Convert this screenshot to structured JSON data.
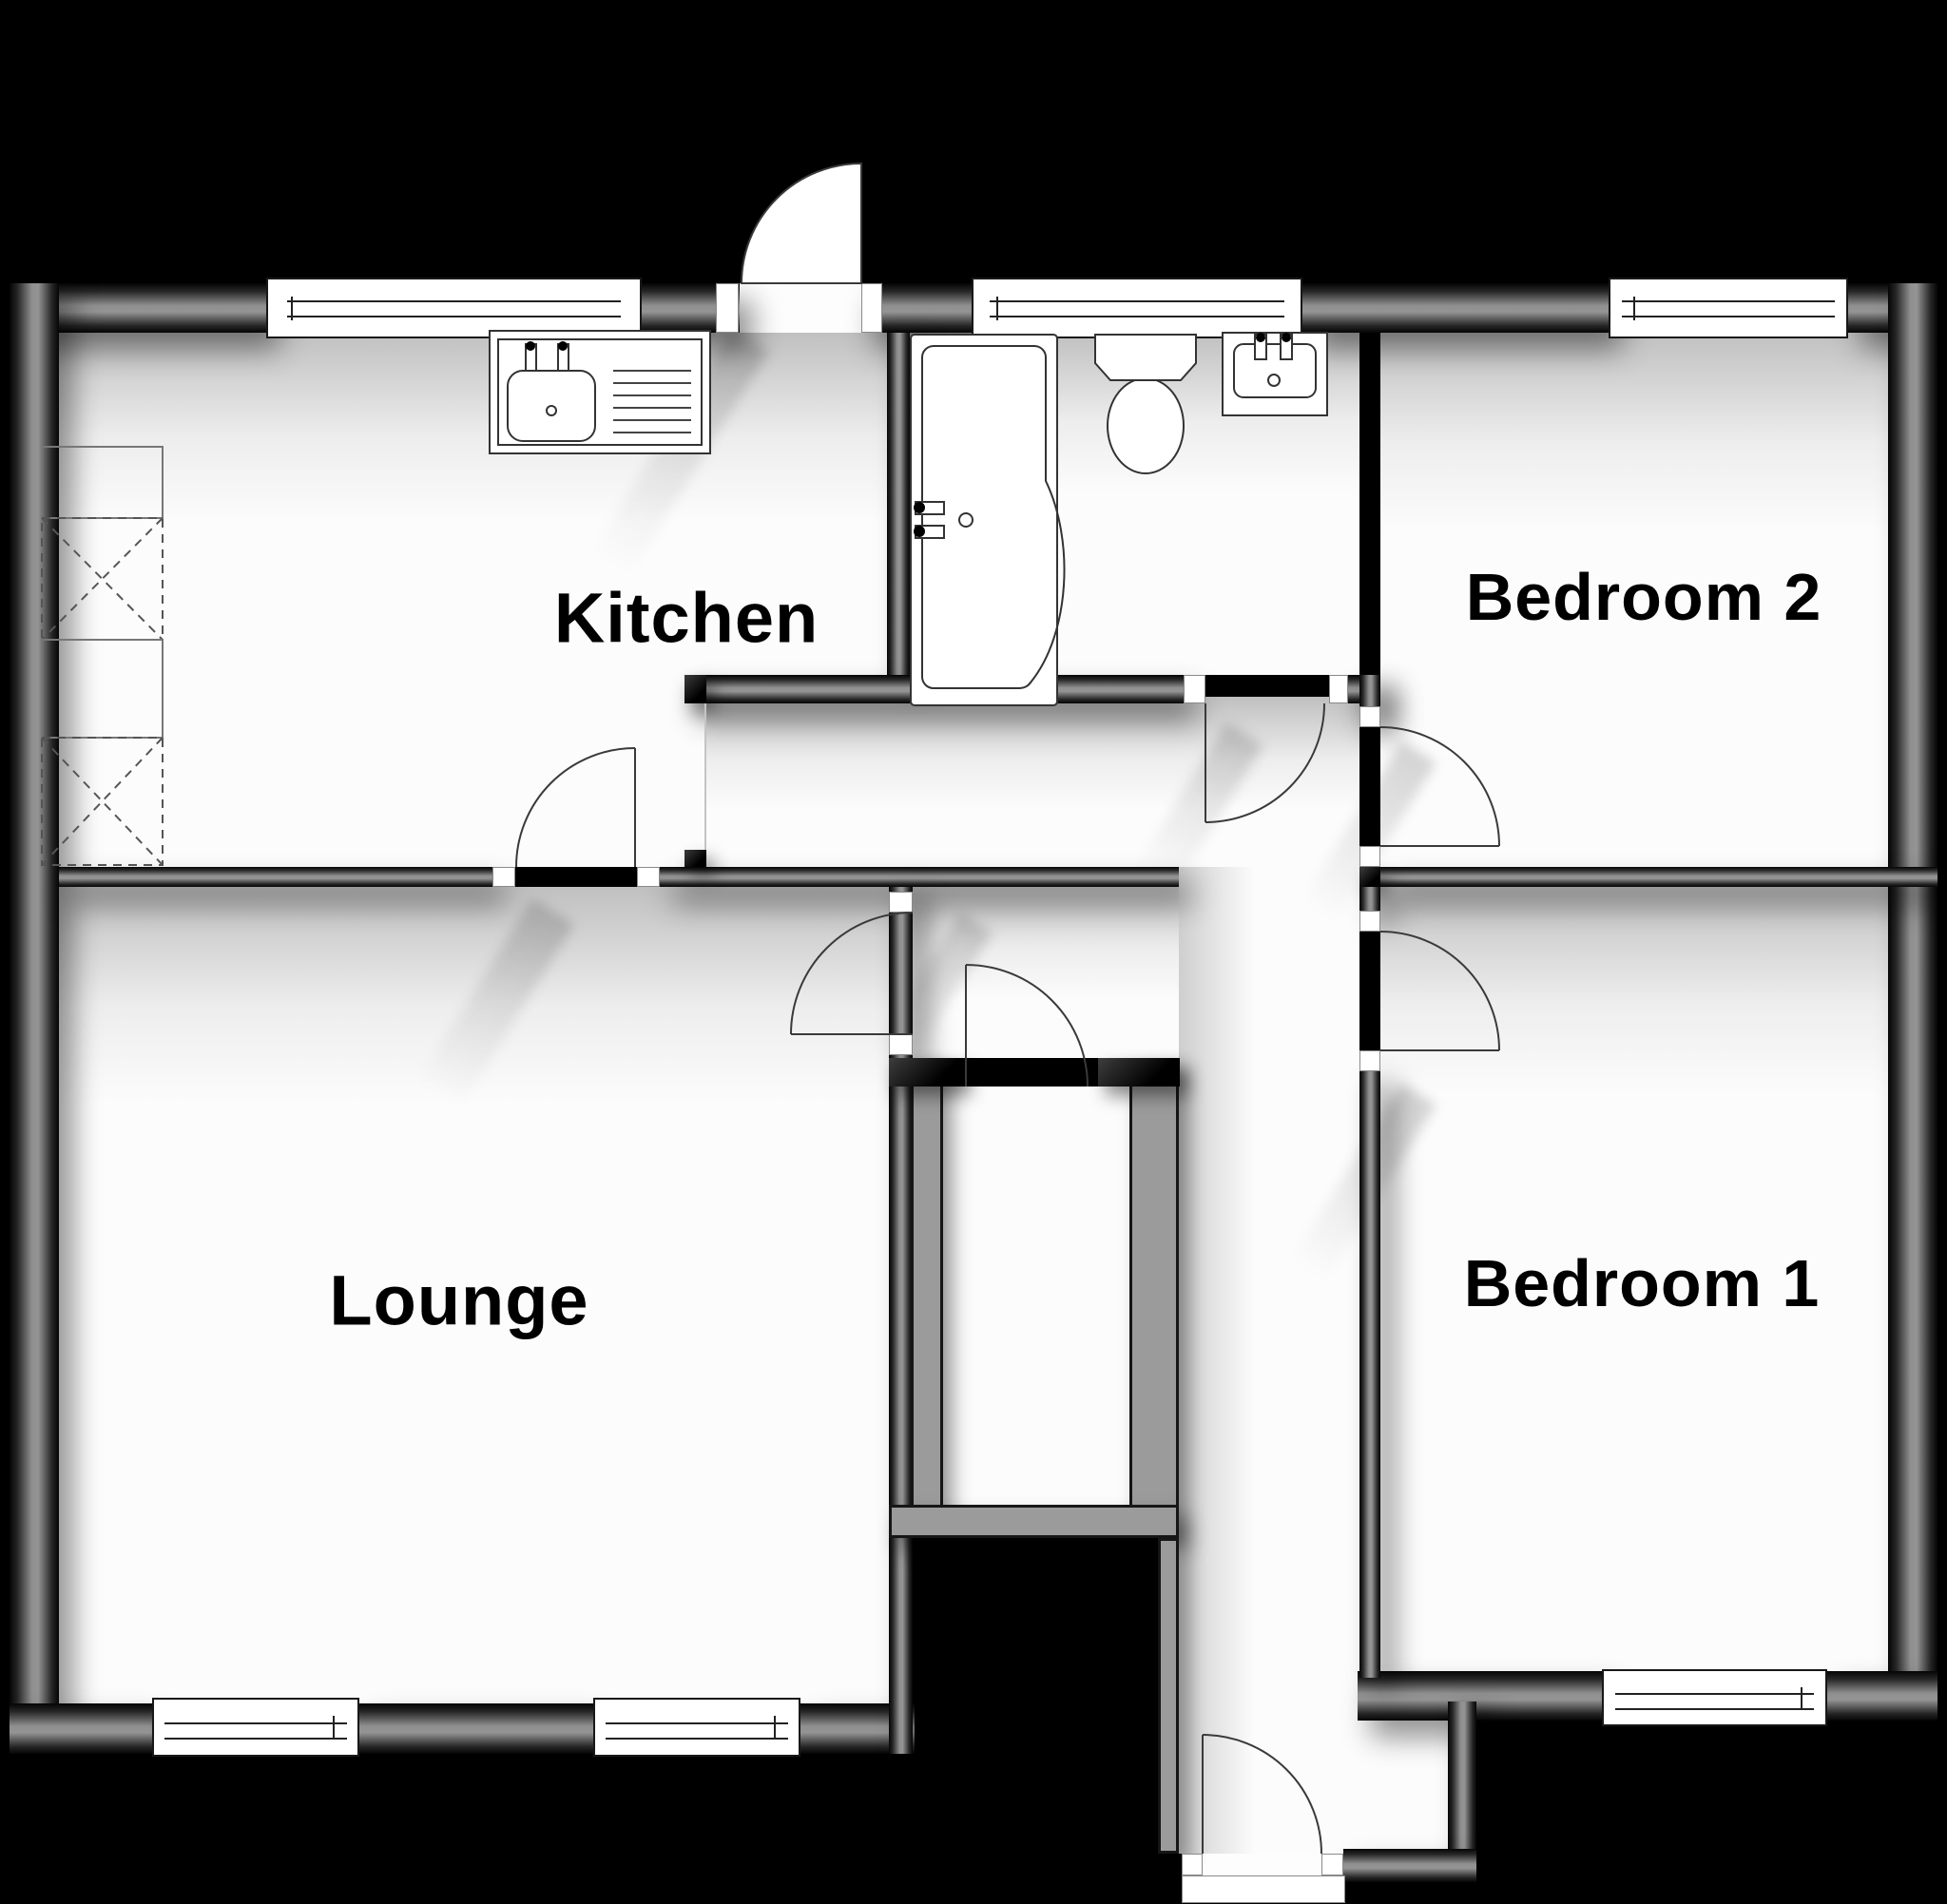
{
  "plan": {
    "type": "residential-floor-plan",
    "colors": {
      "background": "#000000",
      "floor": "#fcfcfc",
      "wall_dark": "#050505",
      "wall_mid": "#919191",
      "partition_gray": "#9b9b9b",
      "line": "#333333",
      "label": "#000000"
    },
    "rooms": [
      {
        "id": "kitchen",
        "label": "Kitchen"
      },
      {
        "id": "lounge",
        "label": "Lounge"
      },
      {
        "id": "bedroom-2",
        "label": "Bedroom 2"
      },
      {
        "id": "bedroom-1",
        "label": "Bedroom 1"
      },
      {
        "id": "bathroom",
        "label": ""
      },
      {
        "id": "hallway",
        "label": ""
      },
      {
        "id": "cupboard",
        "label": ""
      },
      {
        "id": "porch",
        "label": ""
      }
    ],
    "fixtures": [
      {
        "id": "kitchen-sink",
        "name": "sink-and-drainer-unit",
        "room": "kitchen"
      },
      {
        "id": "appliance-spaces",
        "name": "dashed-appliance-boxes",
        "room": "kitchen",
        "count": 2
      },
      {
        "id": "bath",
        "name": "p-shaped-bath-with-taps",
        "room": "bathroom"
      },
      {
        "id": "toilet",
        "name": "toilet-with-cistern",
        "room": "bathroom"
      },
      {
        "id": "basin",
        "name": "wash-hand-basin",
        "room": "bathroom"
      }
    ],
    "doors": [
      {
        "id": "entrance-top",
        "name": "rear-entrance-door",
        "swing": "outward-north"
      },
      {
        "id": "front-door",
        "name": "front-entrance-door",
        "swing": "into-porch"
      },
      {
        "id": "kitchen-lounge",
        "name": "kitchen-to-lounge-door"
      },
      {
        "id": "lounge-hall",
        "name": "lounge-to-hall-door"
      },
      {
        "id": "bathroom-door",
        "name": "bathroom-to-hall-door"
      },
      {
        "id": "bedroom2-door",
        "name": "bedroom-2-door"
      },
      {
        "id": "bedroom1-door",
        "name": "bedroom-1-door"
      },
      {
        "id": "cupboard-door",
        "name": "cupboard-door"
      }
    ],
    "windows": [
      {
        "id": "kitchen-window",
        "wall": "top"
      },
      {
        "id": "bathroom-window",
        "wall": "top"
      },
      {
        "id": "bedroom2-window",
        "wall": "top"
      },
      {
        "id": "lounge-window-1",
        "wall": "bottom"
      },
      {
        "id": "lounge-window-2",
        "wall": "bottom"
      },
      {
        "id": "bedroom1-window",
        "wall": "bottom"
      }
    ]
  }
}
